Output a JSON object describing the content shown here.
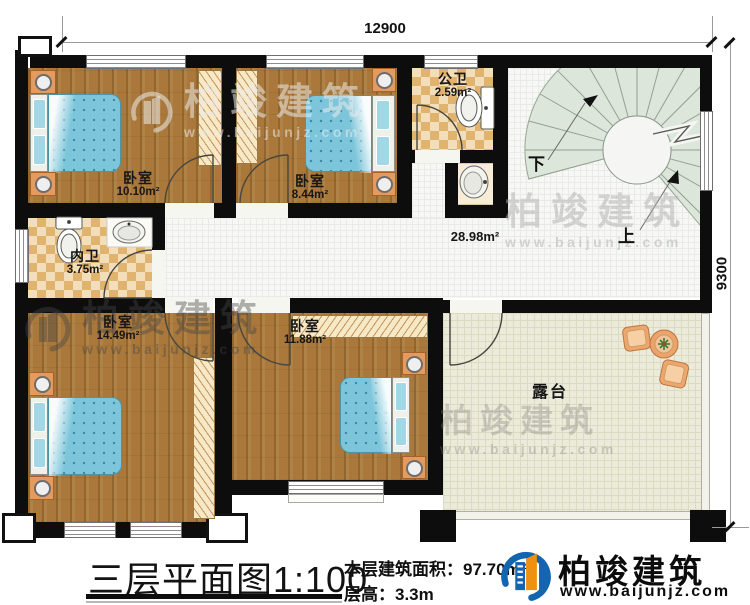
{
  "dimensions": {
    "top": "12900",
    "right": "9300"
  },
  "rooms": {
    "bedroom1": {
      "name": "卧室",
      "area": "10.10m²"
    },
    "bedroom2": {
      "name": "卧室",
      "area": "8.44m²"
    },
    "public_bath": {
      "name": "公卫",
      "area": "2.59m²"
    },
    "inner_bath": {
      "name": "内卫",
      "area": "3.75m²"
    },
    "bedroom3": {
      "name": "卧室",
      "area": "14.49m²"
    },
    "bedroom4": {
      "name": "卧室",
      "area": "11.88m²"
    },
    "hall": {
      "area": "28.98m²"
    },
    "terrace": {
      "name": "露台"
    }
  },
  "stairs": {
    "down_label": "下",
    "up_label": "上"
  },
  "footer": {
    "title": "三层平面图",
    "scale": "1:100",
    "floor_area": "本层建筑面积：97.70m²",
    "floor_height": "层高：3.3m"
  },
  "brand": {
    "name": "柏竣建筑",
    "website": "www.baijunjz.com"
  },
  "watermark": {
    "name": "柏竣建筑",
    "website": "www.baijunjz.com"
  },
  "colors": {
    "wall": "#0d0d0d",
    "wood_floor": "#a9783a",
    "tile_floor": "#f3debb",
    "hall_floor": "#f7f8f5",
    "terrace_floor": "#ecebdb",
    "bed": "#7cc5da",
    "furniture_orange": "#e59a5e",
    "logo_blue": "#1465b0",
    "logo_orange": "#f0900f"
  }
}
